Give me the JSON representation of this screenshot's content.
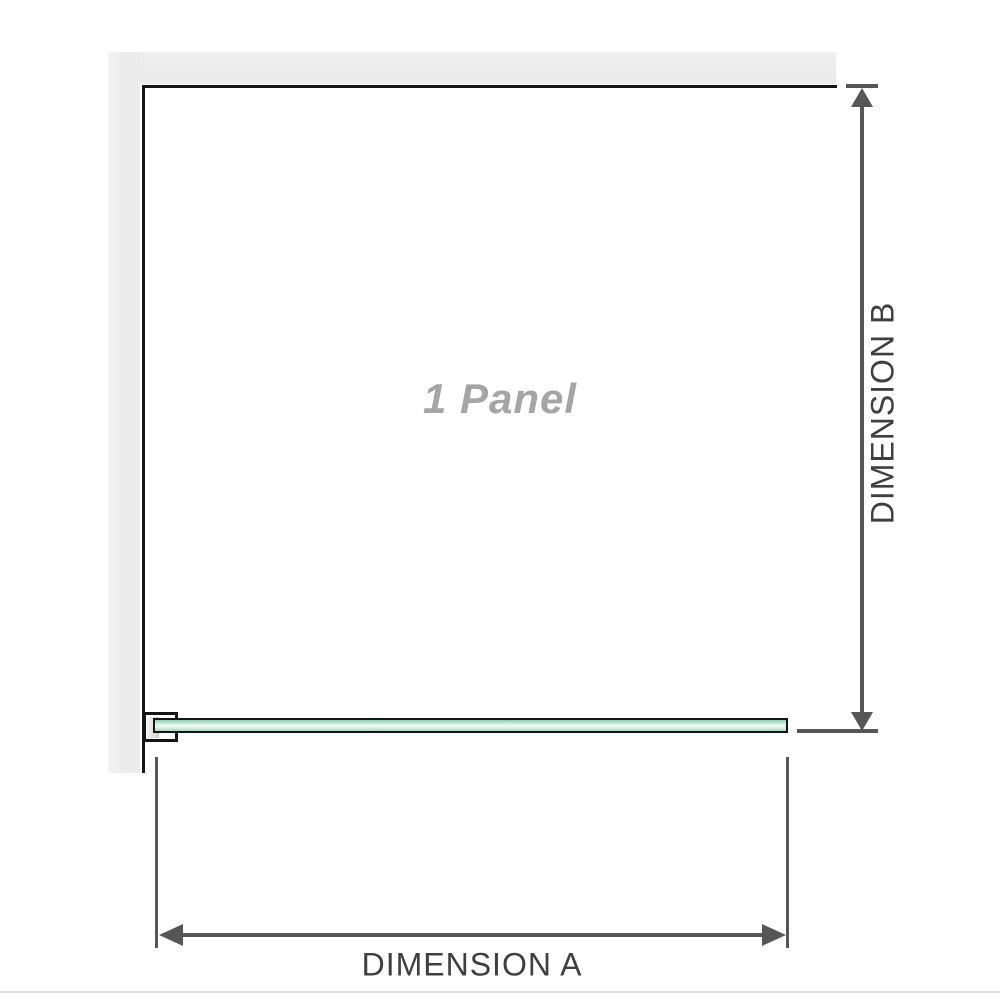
{
  "diagram": {
    "panel_label": "1 Panel",
    "dimension_a_label": "DIMENSION A",
    "dimension_b_label": "DIMENSION B"
  },
  "colors": {
    "wall": "#ebebeb",
    "outline": "#141414",
    "dimension_line": "#565656",
    "dimension_text": "#3f3f3f",
    "panel_text": "#a5a5a5",
    "glass_dark": "#8fcfae",
    "glass_light": "#eaf7f0",
    "glass_medium": "#a7dabe",
    "bracket_liner_light": "#f4f4f4",
    "bracket_liner_dark": "#cfcfcf",
    "page_border": "#dcdcdc"
  }
}
